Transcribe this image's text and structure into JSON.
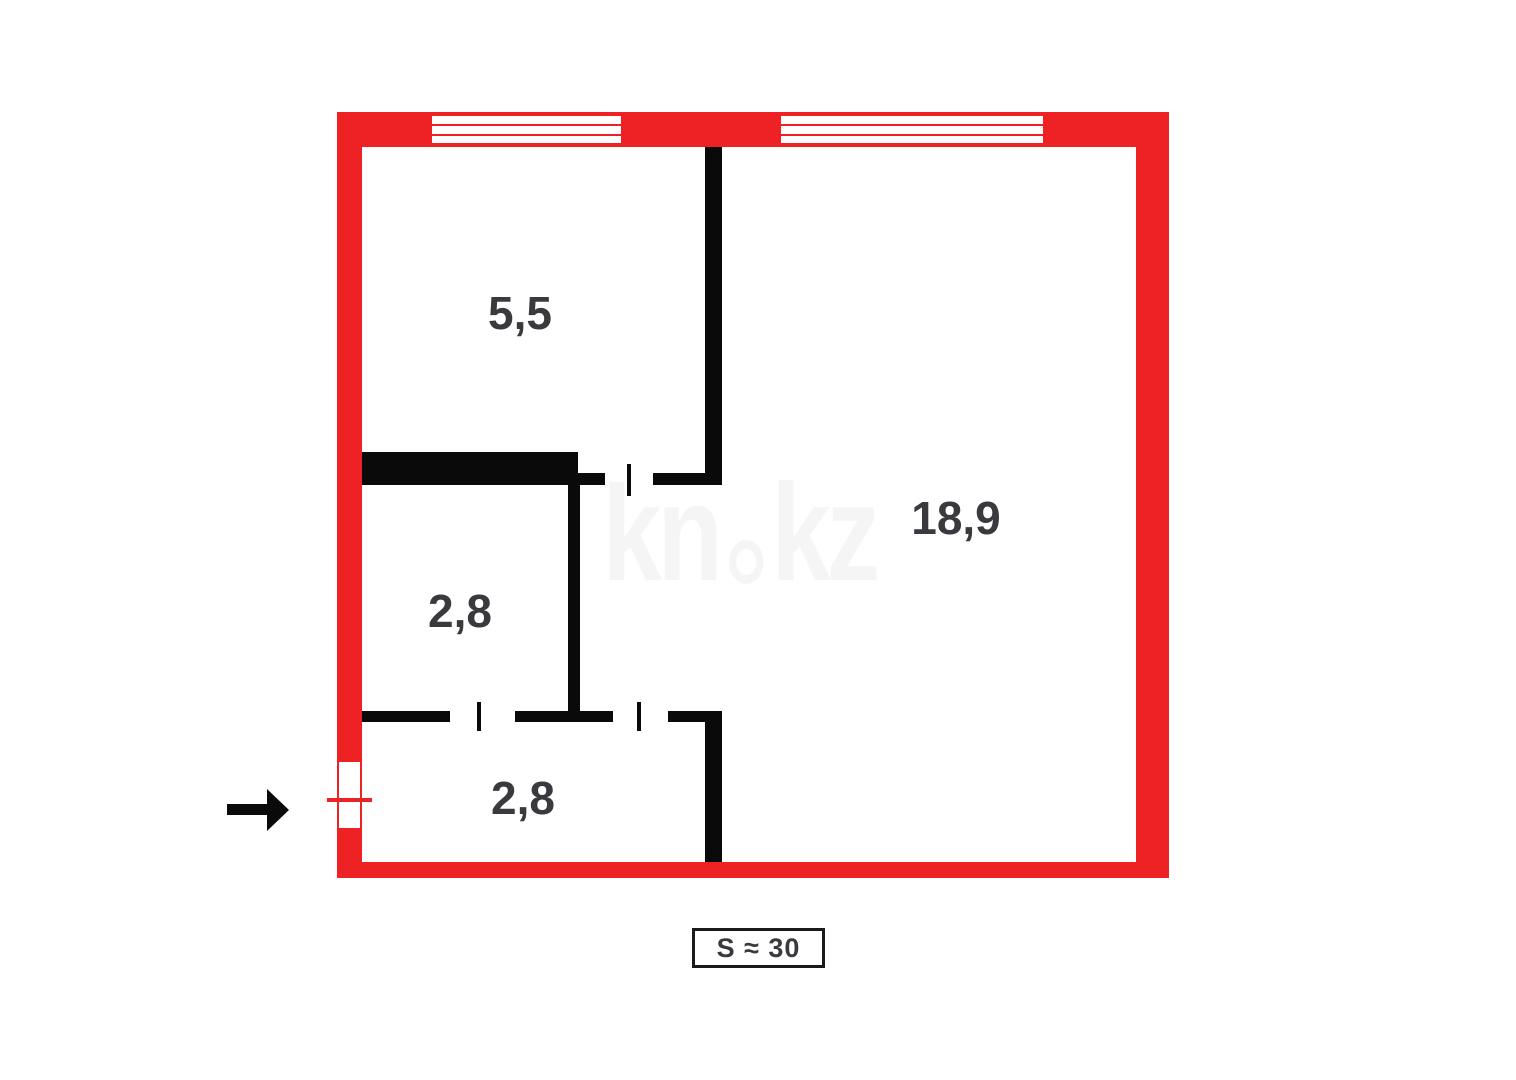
{
  "floor_plan": {
    "watermark": {
      "part1": "kn",
      "part2": "kz"
    },
    "rooms": [
      {
        "id": "kitchen-top-left",
        "area_label": "5,5"
      },
      {
        "id": "living-room-right",
        "area_label": "18,9"
      },
      {
        "id": "bathroom-middle-left",
        "area_label": "2,8"
      },
      {
        "id": "hallway-bottom",
        "area_label": "2,8"
      }
    ],
    "total_area": {
      "label": "S ≈ 30"
    },
    "icons": {
      "entrance_arrow": "right-arrow"
    },
    "colors": {
      "outer_wall": "#ee2125",
      "interior_wall": "#0a0a0a",
      "label_text": "#3a3a3e",
      "watermark": "#f5f5f5",
      "background": "#ffffff"
    }
  }
}
